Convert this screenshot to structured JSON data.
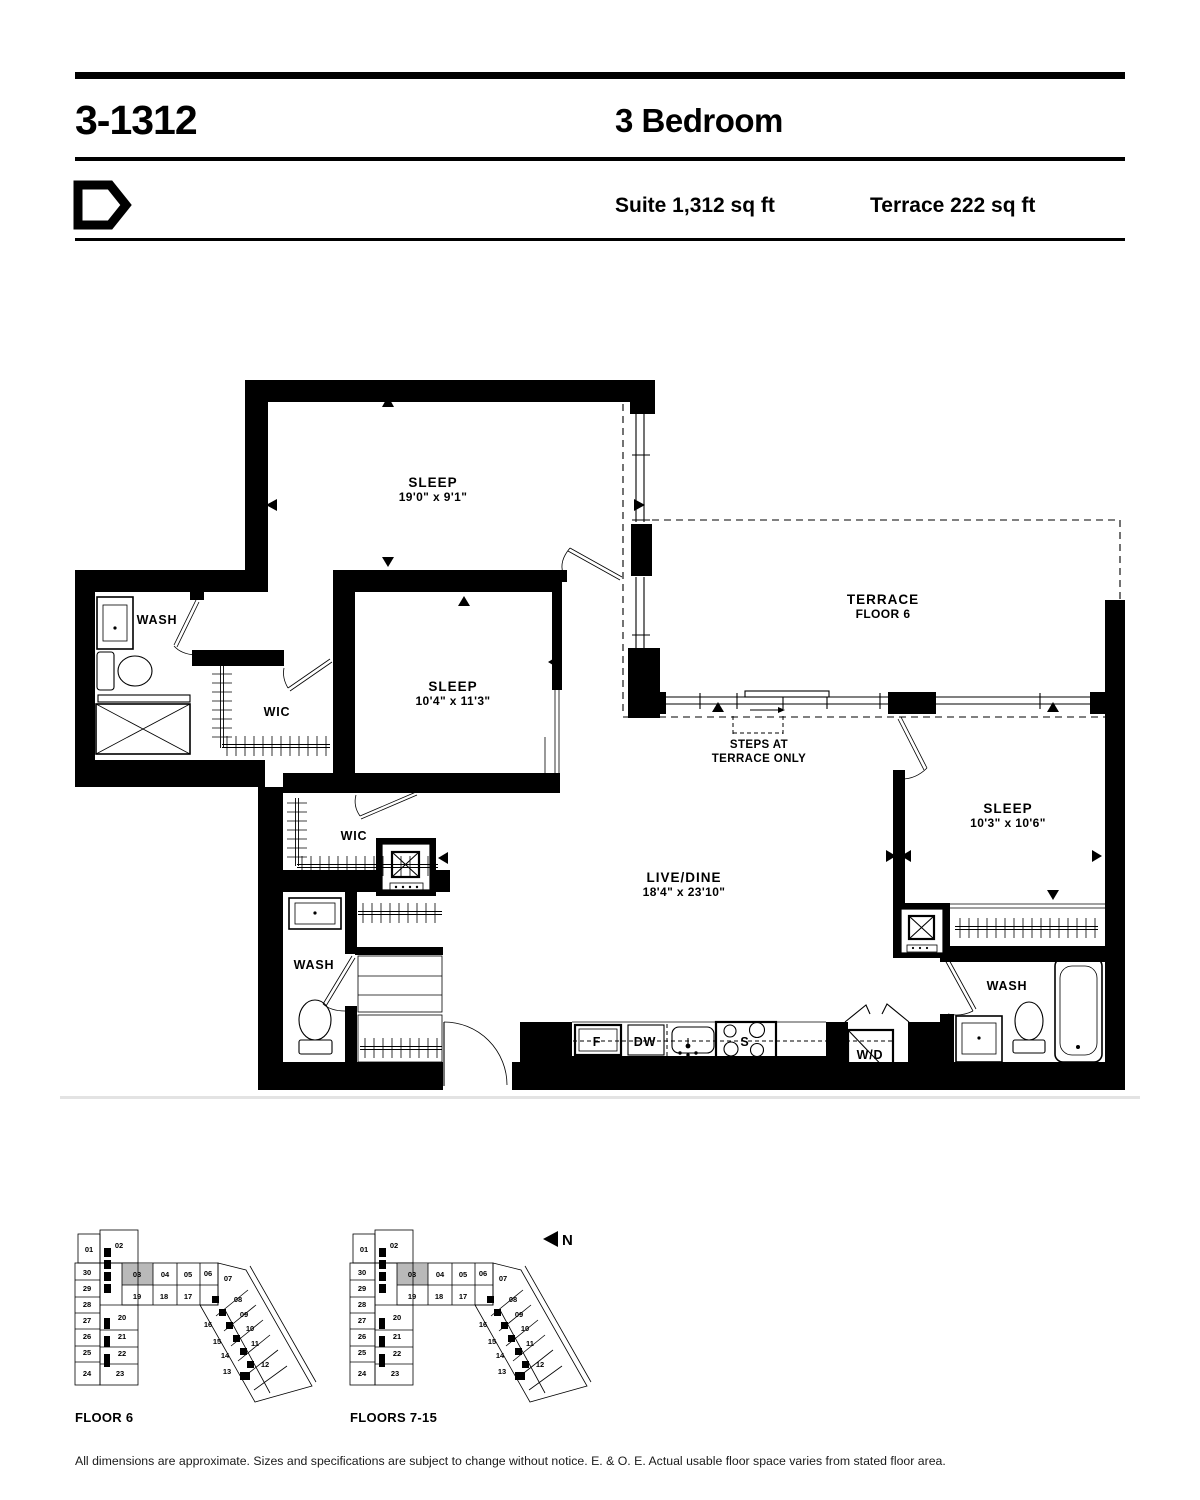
{
  "header": {
    "title": "3-1312",
    "subtitle": "3 Bedroom",
    "suite": "Suite 1,312 sq ft",
    "terrace": "Terrace 222 sq ft"
  },
  "floorplan": {
    "rooms": [
      {
        "name": "SLEEP",
        "dims": "19'0\" x 9'1\"",
        "x": 433,
        "y": 487
      },
      {
        "name": "SLEEP",
        "dims": "10'4\" x 11'3\"",
        "x": 453,
        "y": 691
      },
      {
        "name": "SLEEP",
        "dims": "10'3\" x 10'6\"",
        "x": 1008,
        "y": 813
      },
      {
        "name": "LIVE/DINE",
        "dims": "18'4\" x 23'10\"",
        "x": 684,
        "y": 882
      },
      {
        "name": "TERRACE",
        "dims": "FLOOR 6",
        "x": 883,
        "y": 604
      }
    ],
    "labels": [
      {
        "text": "WASH",
        "x": 157,
        "y": 624
      },
      {
        "text": "WIC",
        "x": 277,
        "y": 716
      },
      {
        "text": "WIC",
        "x": 354,
        "y": 840
      },
      {
        "text": "WASH",
        "x": 314,
        "y": 969
      },
      {
        "text": "WASH",
        "x": 1007,
        "y": 990
      },
      {
        "text": "F",
        "x": 597,
        "y": 1046
      },
      {
        "text": "DW",
        "x": 645,
        "y": 1046
      },
      {
        "text": "S",
        "x": 745,
        "y": 1046
      },
      {
        "text": "W/D",
        "x": 870,
        "y": 1059
      }
    ],
    "annotations": [
      {
        "text": "STEPS AT",
        "x": 759,
        "y": 748
      },
      {
        "text": "TERRACE ONLY",
        "x": 759,
        "y": 762
      }
    ]
  },
  "keyplan": {
    "captions": [
      "FLOOR 6",
      "FLOORS 7-15"
    ],
    "north": "N",
    "highlighted_unit": "03",
    "highlight_color": "#b9b9b9",
    "units": [
      {
        "n": "01",
        "x": 89,
        "y": 1252
      },
      {
        "n": "02",
        "x": 119,
        "y": 1248
      },
      {
        "n": "30",
        "x": 87,
        "y": 1275
      },
      {
        "n": "29",
        "x": 87,
        "y": 1291
      },
      {
        "n": "28",
        "x": 87,
        "y": 1307
      },
      {
        "n": "27",
        "x": 87,
        "y": 1323
      },
      {
        "n": "26",
        "x": 87,
        "y": 1339
      },
      {
        "n": "25",
        "x": 87,
        "y": 1355
      },
      {
        "n": "24",
        "x": 87,
        "y": 1376
      },
      {
        "n": "23",
        "x": 120,
        "y": 1376
      },
      {
        "n": "20",
        "x": 122,
        "y": 1320
      },
      {
        "n": "21",
        "x": 122,
        "y": 1339
      },
      {
        "n": "22",
        "x": 122,
        "y": 1356
      },
      {
        "n": "03",
        "x": 137,
        "y": 1277
      },
      {
        "n": "04",
        "x": 165,
        "y": 1277
      },
      {
        "n": "05",
        "x": 188,
        "y": 1277
      },
      {
        "n": "06",
        "x": 208,
        "y": 1276
      },
      {
        "n": "07",
        "x": 228,
        "y": 1281
      },
      {
        "n": "19",
        "x": 137,
        "y": 1299
      },
      {
        "n": "18",
        "x": 164,
        "y": 1299
      },
      {
        "n": "17",
        "x": 188,
        "y": 1299
      },
      {
        "n": "08",
        "x": 238,
        "y": 1302
      },
      {
        "n": "09",
        "x": 244,
        "y": 1317
      },
      {
        "n": "10",
        "x": 250,
        "y": 1331
      },
      {
        "n": "11",
        "x": 255,
        "y": 1346
      },
      {
        "n": "12",
        "x": 265,
        "y": 1367
      },
      {
        "n": "16",
        "x": 208,
        "y": 1327
      },
      {
        "n": "15",
        "x": 217,
        "y": 1344
      },
      {
        "n": "14",
        "x": 225,
        "y": 1358
      },
      {
        "n": "13",
        "x": 227,
        "y": 1374
      }
    ]
  },
  "footer": {
    "disclaimer": "All dimensions are approximate. Sizes and specifications are subject to change without notice. E. & O. E. Actual usable floor space varies from stated floor area."
  }
}
